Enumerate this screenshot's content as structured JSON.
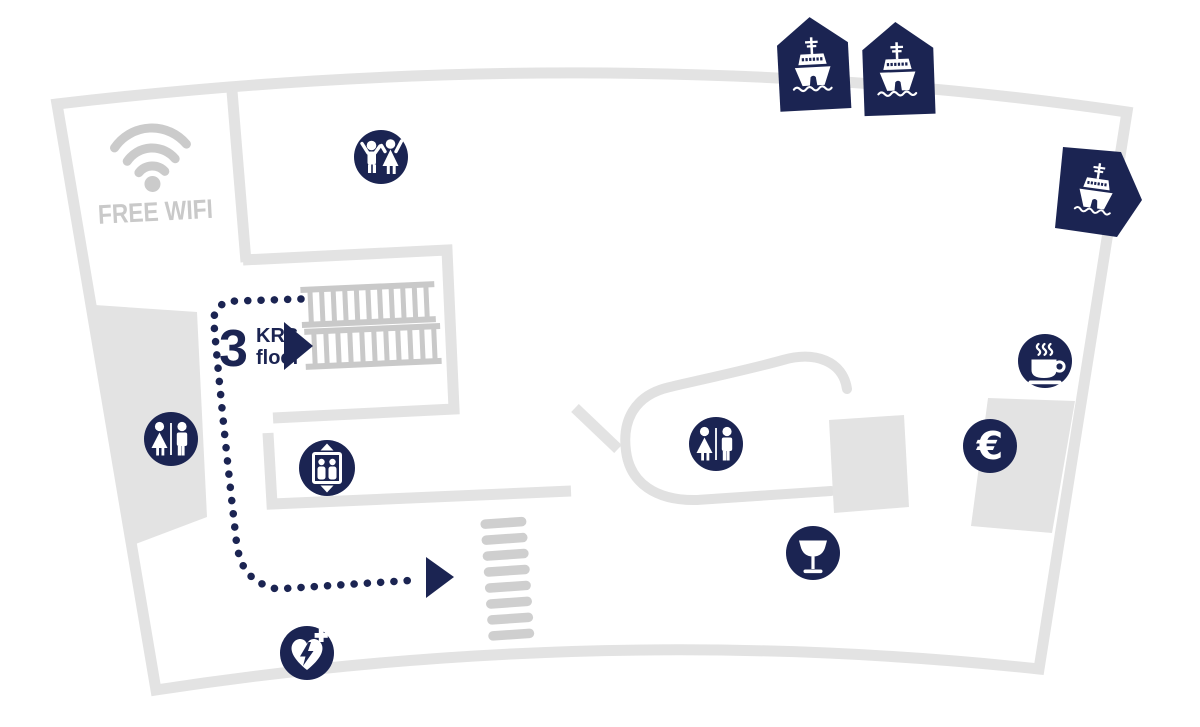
{
  "map": {
    "name": "terminal-floor-plan",
    "description": "Fan-shaped ferry terminal floor plan with service icons and a dotted walking route"
  },
  "wifi": {
    "label": "FREE WIFI"
  },
  "floor": {
    "number": "3",
    "abbr": "KRS.",
    "word": "floor"
  },
  "currency": {
    "symbol": "€"
  },
  "colors": {
    "navy": "#1b2452",
    "wall_gray": "#e3e3e3",
    "label_gray": "#c9c9c9",
    "stair_gray": "#c9c9c9",
    "zebra_gray": "#cfcfcf",
    "icon_glyph": "#ffffff"
  },
  "icons": {
    "wifi-icon": "wifi arcs",
    "kids-playroom-icon": "two children holding hands",
    "restroom-icon-left": "woman and man divided",
    "restroom-icon-center": "woman and man divided",
    "elevator-icon": "two people in car with up/down arrows",
    "coffee-icon": "steaming cup on saucer",
    "currency-exchange-icon": "euro sign",
    "bar-icon": "stemmed glass",
    "defibrillator-icon": "heart with lightning bolt and cross",
    "ship-marker-1": "ferry in upward pentagon",
    "ship-marker-2": "ferry in upward pentagon",
    "ship-marker-3": "ferry in right-pointing pentagon",
    "route-arrow": "dotted path with arrowhead",
    "stairs": "double stair flight",
    "steps": "zebra steps"
  }
}
